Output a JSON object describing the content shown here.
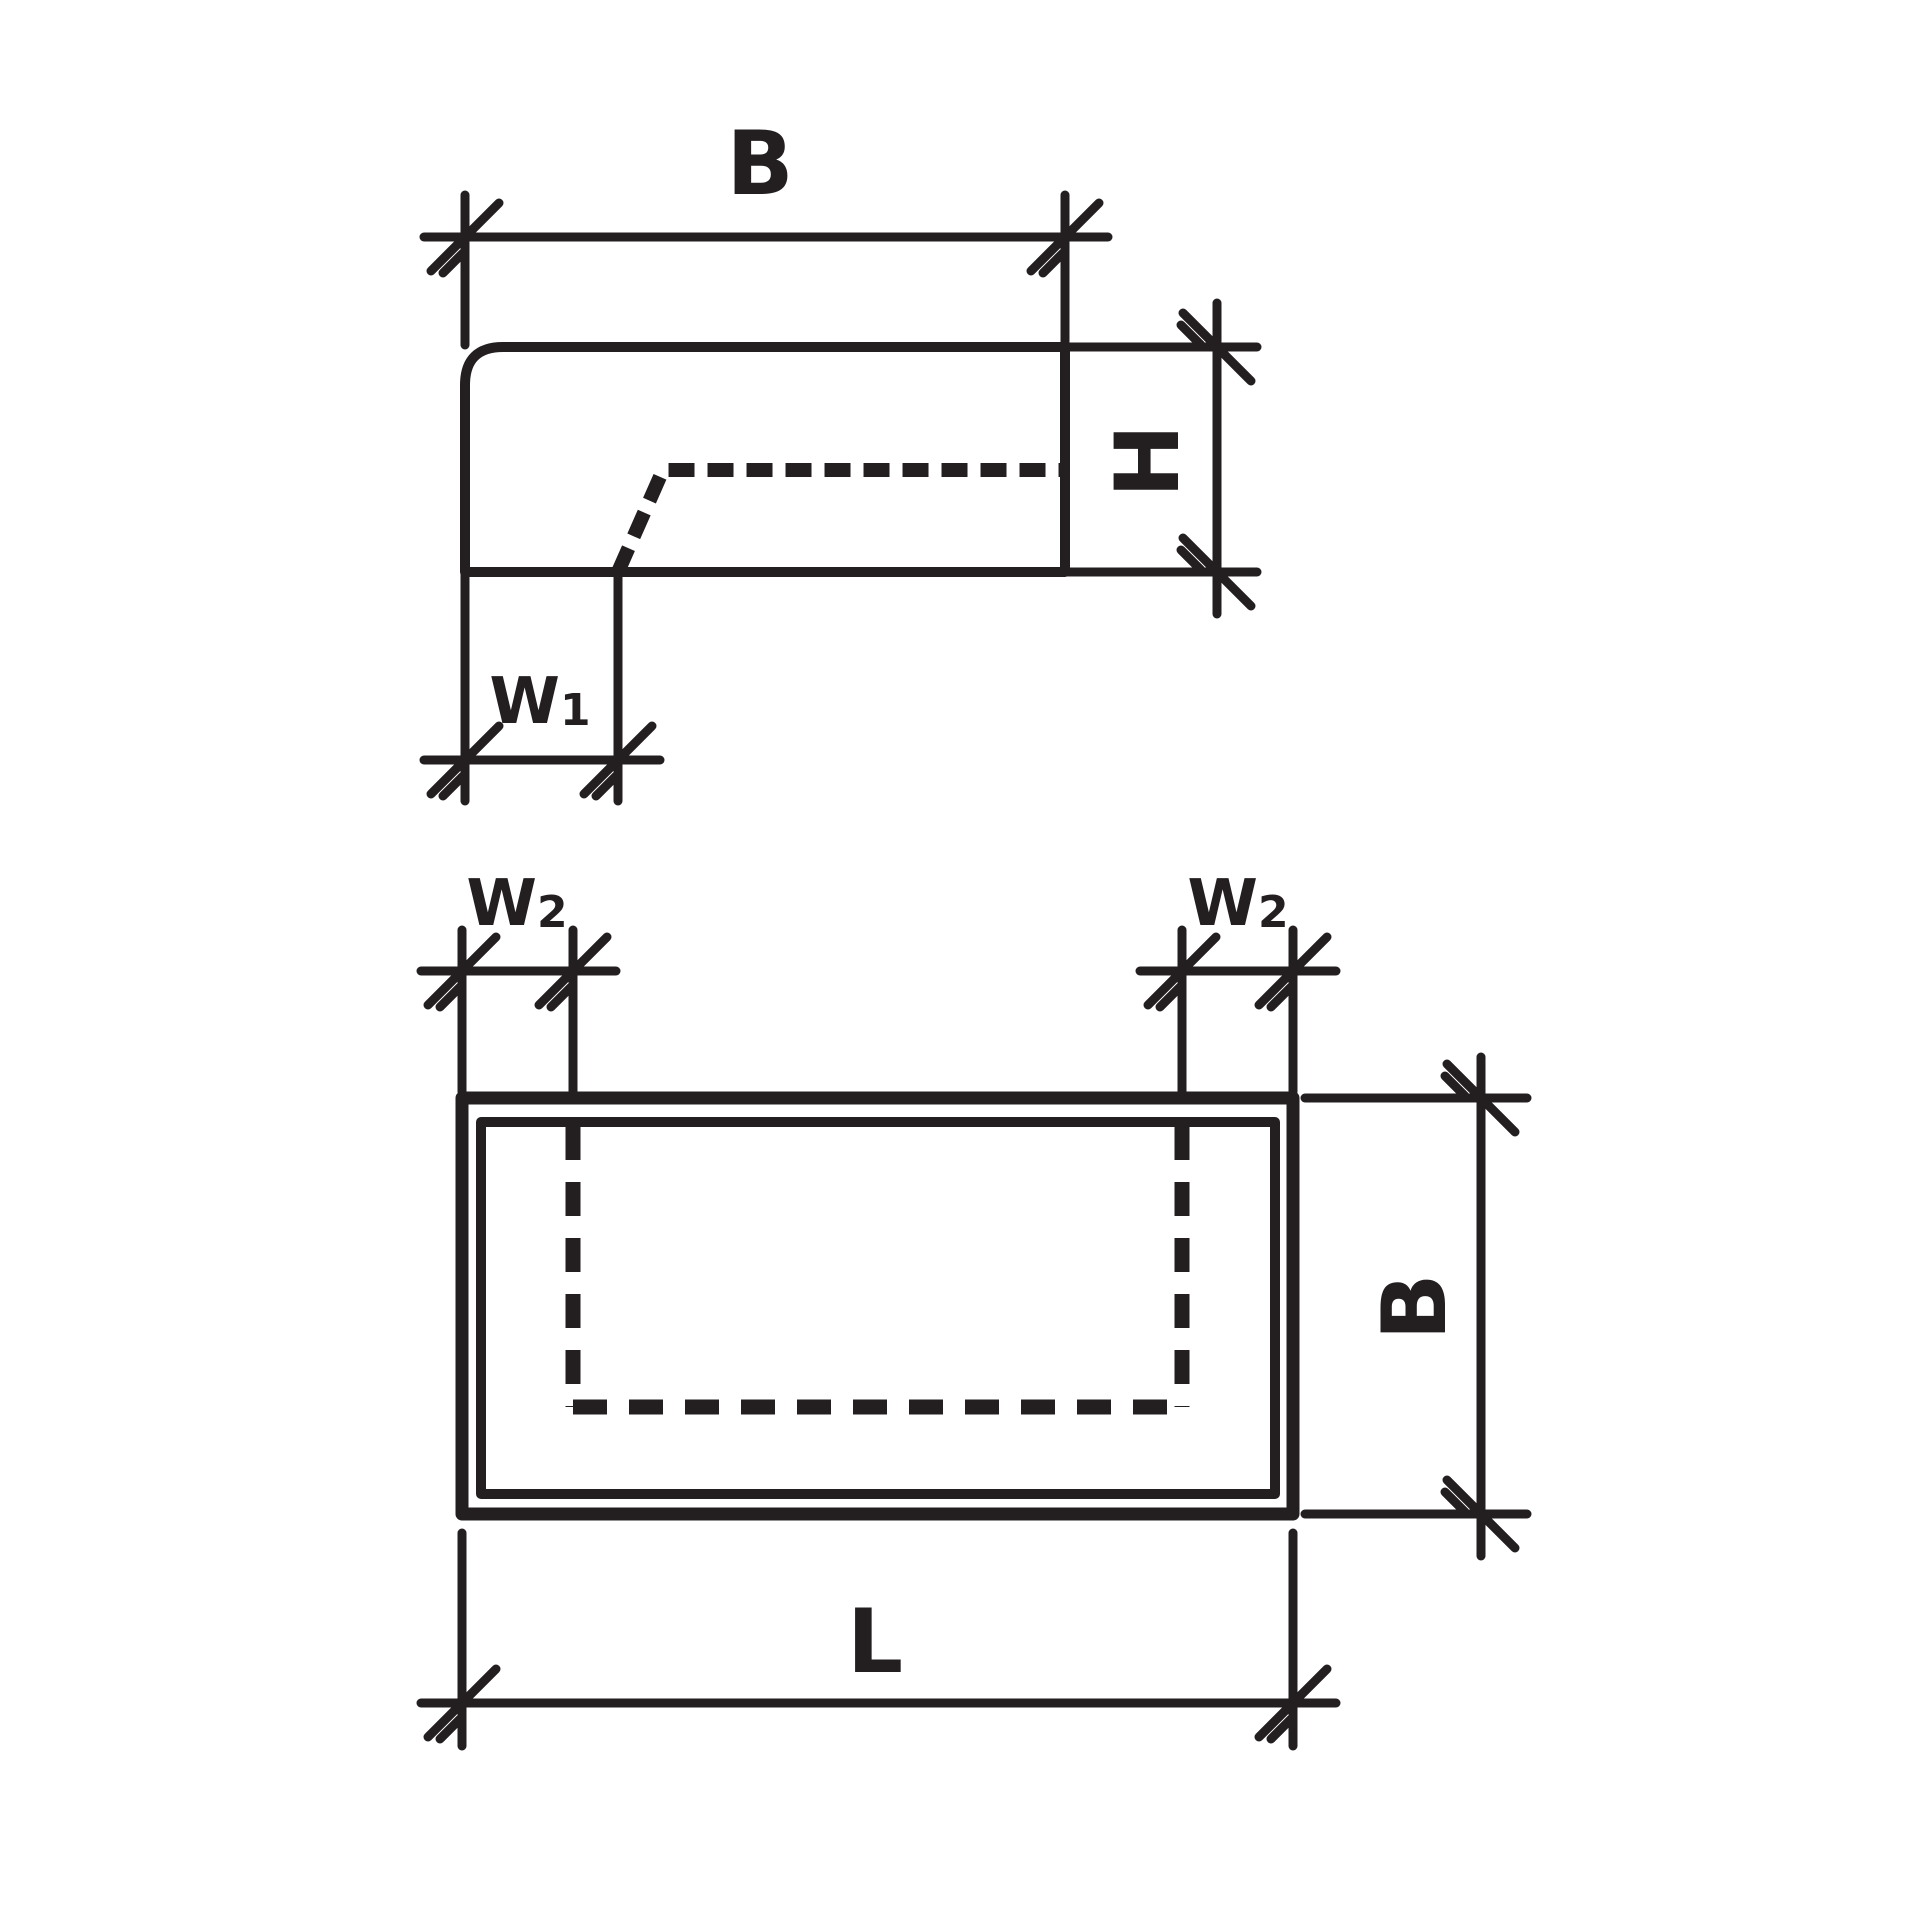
{
  "colors": {
    "line": "#231f20",
    "background": "#ffffff"
  },
  "end_view": {
    "dim_width_label": "B",
    "dim_height_label": "H",
    "dim_w1_base": "W",
    "dim_w1_sub": "1"
  },
  "plan_view": {
    "dim_w2_left_base": "W",
    "dim_w2_left_sub": "2",
    "dim_w2_right_base": "W",
    "dim_w2_right_sub": "2",
    "dim_width_label": "B",
    "dim_length_label": "L"
  }
}
